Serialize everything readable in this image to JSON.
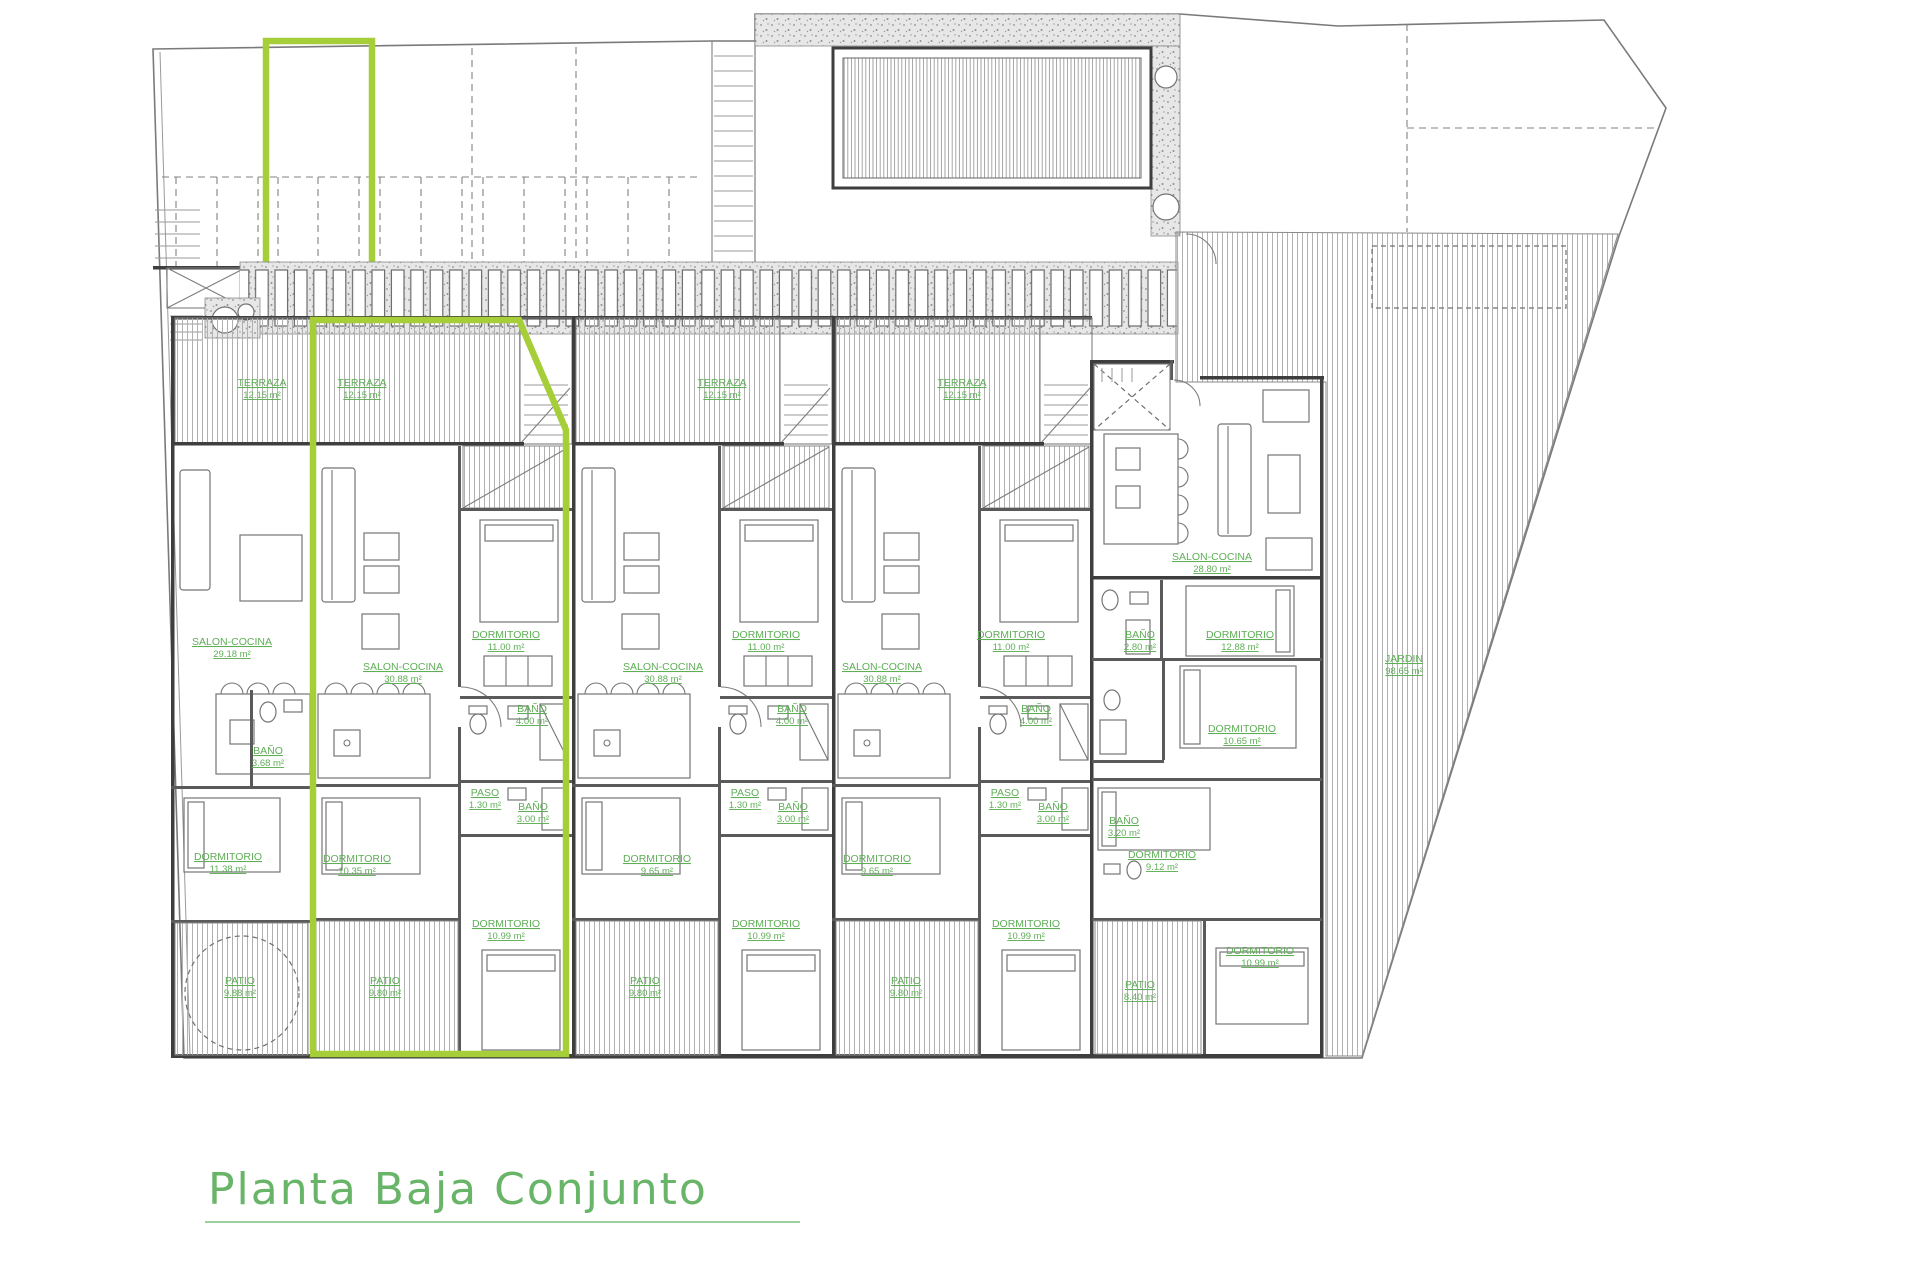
{
  "title": {
    "text": "Planta Baja Conjunto"
  },
  "colors": {
    "highlight": "#a6ce39",
    "room_label": "#5fae57",
    "title": "#68b468"
  },
  "garden": {
    "name": "JARDIN",
    "area": "98.65 m²"
  },
  "units": [
    {
      "terraza": {
        "name": "TERRAZA",
        "area": "12.15 m²"
      },
      "salon": {
        "name": "SALON-COCINA",
        "area": "29.18 m²"
      },
      "bano": {
        "name": "BAÑO",
        "area": "3.68 m²"
      },
      "dorm1": {
        "name": "DORMITORIO",
        "area": "11.38 m²"
      },
      "patio": {
        "name": "PATIO",
        "area": "9.88 m²"
      }
    },
    {
      "terraza": {
        "name": "TERRAZA",
        "area": "12.15 m²"
      },
      "salon": {
        "name": "SALON-COCINA",
        "area": "30.88 m²"
      },
      "dorm1": {
        "name": "DORMITORIO",
        "area": "11.00 m²"
      },
      "bano1": {
        "name": "BAÑO",
        "area": "4.00 m²"
      },
      "paso": {
        "name": "PASO",
        "area": "1.30 m²"
      },
      "bano2": {
        "name": "BAÑO",
        "area": "3.00 m²"
      },
      "dorm2": {
        "name": "DORMITORIO",
        "area": "10.35 m²"
      },
      "dorm3": {
        "name": "DORMITORIO",
        "area": "10.99 m²"
      },
      "patio": {
        "name": "PATIO",
        "area": "9.80 m²"
      }
    },
    {
      "terraza": {
        "name": "TERRAZA",
        "area": "12.15 m²"
      },
      "salon": {
        "name": "SALON-COCINA",
        "area": "30.88 m²"
      },
      "dorm1": {
        "name": "DORMITORIO",
        "area": "11.00 m²"
      },
      "bano1": {
        "name": "BAÑO",
        "area": "4.00 m²"
      },
      "paso": {
        "name": "PASO",
        "area": "1.30 m²"
      },
      "bano2": {
        "name": "BAÑO",
        "area": "3.00 m²"
      },
      "dorm2": {
        "name": "DORMITORIO",
        "area": "9.65 m²"
      },
      "dorm3": {
        "name": "DORMITORIO",
        "area": "10.99 m²"
      },
      "patio": {
        "name": "PATIO",
        "area": "9.80 m²"
      }
    },
    {
      "terraza": {
        "name": "TERRAZA",
        "area": "12.15 m²"
      },
      "salon": {
        "name": "SALON-COCINA",
        "area": "30.88 m²"
      },
      "dorm1": {
        "name": "DORMITORIO",
        "area": "11.00 m²"
      },
      "bano1": {
        "name": "BAÑO",
        "area": "4.00 m²"
      },
      "paso": {
        "name": "PASO",
        "area": "1.30 m²"
      },
      "bano2": {
        "name": "BAÑO",
        "area": "3.00 m²"
      },
      "dorm2": {
        "name": "DORMITORIO",
        "area": "9.65 m²"
      },
      "dorm3": {
        "name": "DORMITORIO",
        "area": "10.99 m²"
      },
      "patio": {
        "name": "PATIO",
        "area": "9.80 m²"
      }
    },
    {
      "salon": {
        "name": "SALON-COCINA",
        "area": "28.80 m²"
      },
      "bano1": {
        "name": "BAÑO",
        "area": "2.80 m²"
      },
      "dorm1": {
        "name": "DORMITORIO",
        "area": "12.88 m²"
      },
      "dorm2": {
        "name": "DORMITORIO",
        "area": "10.65 m²"
      },
      "bano2": {
        "name": "BAÑO",
        "area": "3.20 m²"
      },
      "dorm3": {
        "name": "DORMITORIO",
        "area": "9.12 m²"
      },
      "dorm4": {
        "name": "DORMITORIO",
        "area": "10.99 m²"
      },
      "patio": {
        "name": "PATIO",
        "area": "8.40 m²"
      }
    }
  ]
}
